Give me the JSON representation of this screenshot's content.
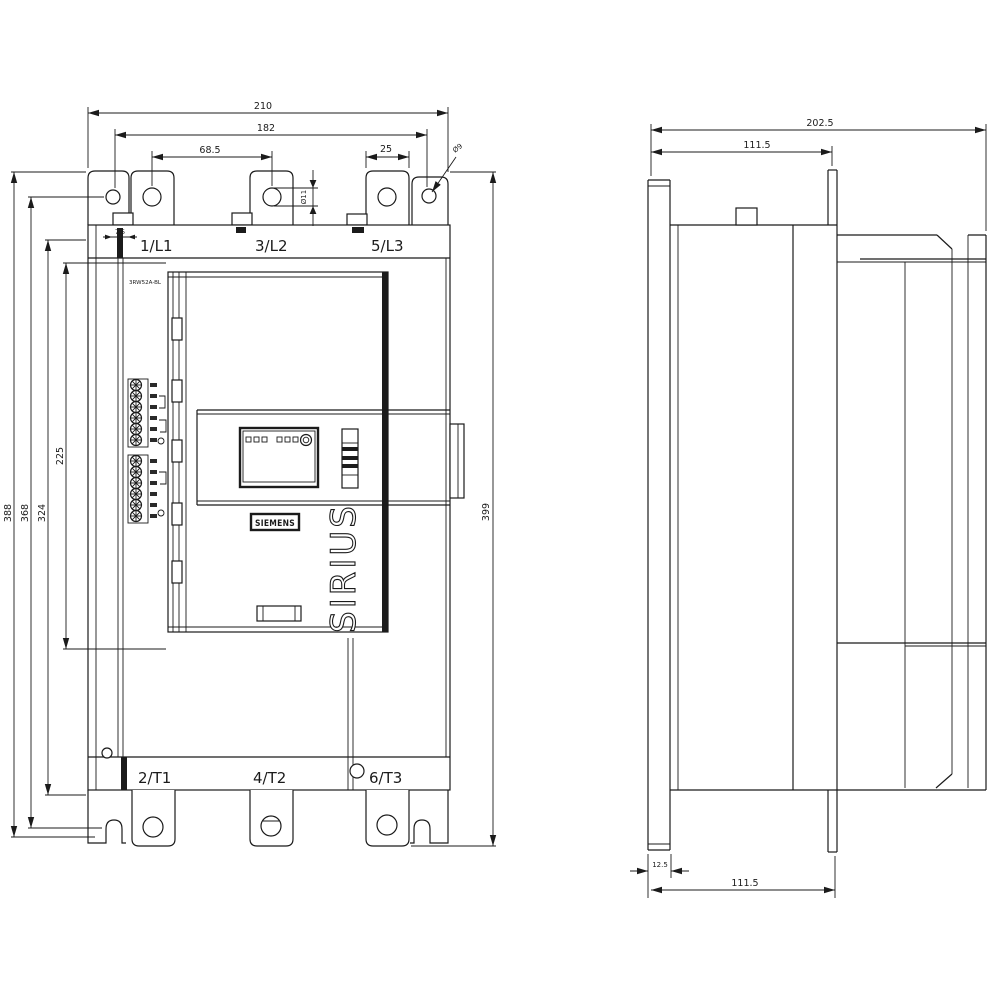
{
  "drawing": {
    "brand": "SIEMENS",
    "series": "SIRIUS",
    "type_label": "3RW52A-BL",
    "front_view": {
      "terminals_top": {
        "l1": "1/L1",
        "l2": "3/L2",
        "l3": "5/L3"
      },
      "terminals_bottom": {
        "t1": "2/T1",
        "t2": "4/T2",
        "t3": "6/T3"
      }
    }
  },
  "dimensions_mm": {
    "overall_width": "210",
    "mounting_hole_spacing_h": "182",
    "terminal_spacing": "68.5",
    "terminal_tab_width": "25",
    "mounting_hole_diameter": "Ø9",
    "terminal_hole_diameter": "Ø11",
    "busbar_offset": "7.5",
    "overall_height": "388",
    "mounting_hole_spacing_v": "368",
    "housing_height": "324",
    "front_cover_height": "225",
    "height_incl_terminals": "399",
    "overall_depth": "202.5",
    "depth_to_tab_top": "111.5",
    "back_strip_depth": "12.5",
    "depth_to_foot_bottom": "111.5"
  }
}
